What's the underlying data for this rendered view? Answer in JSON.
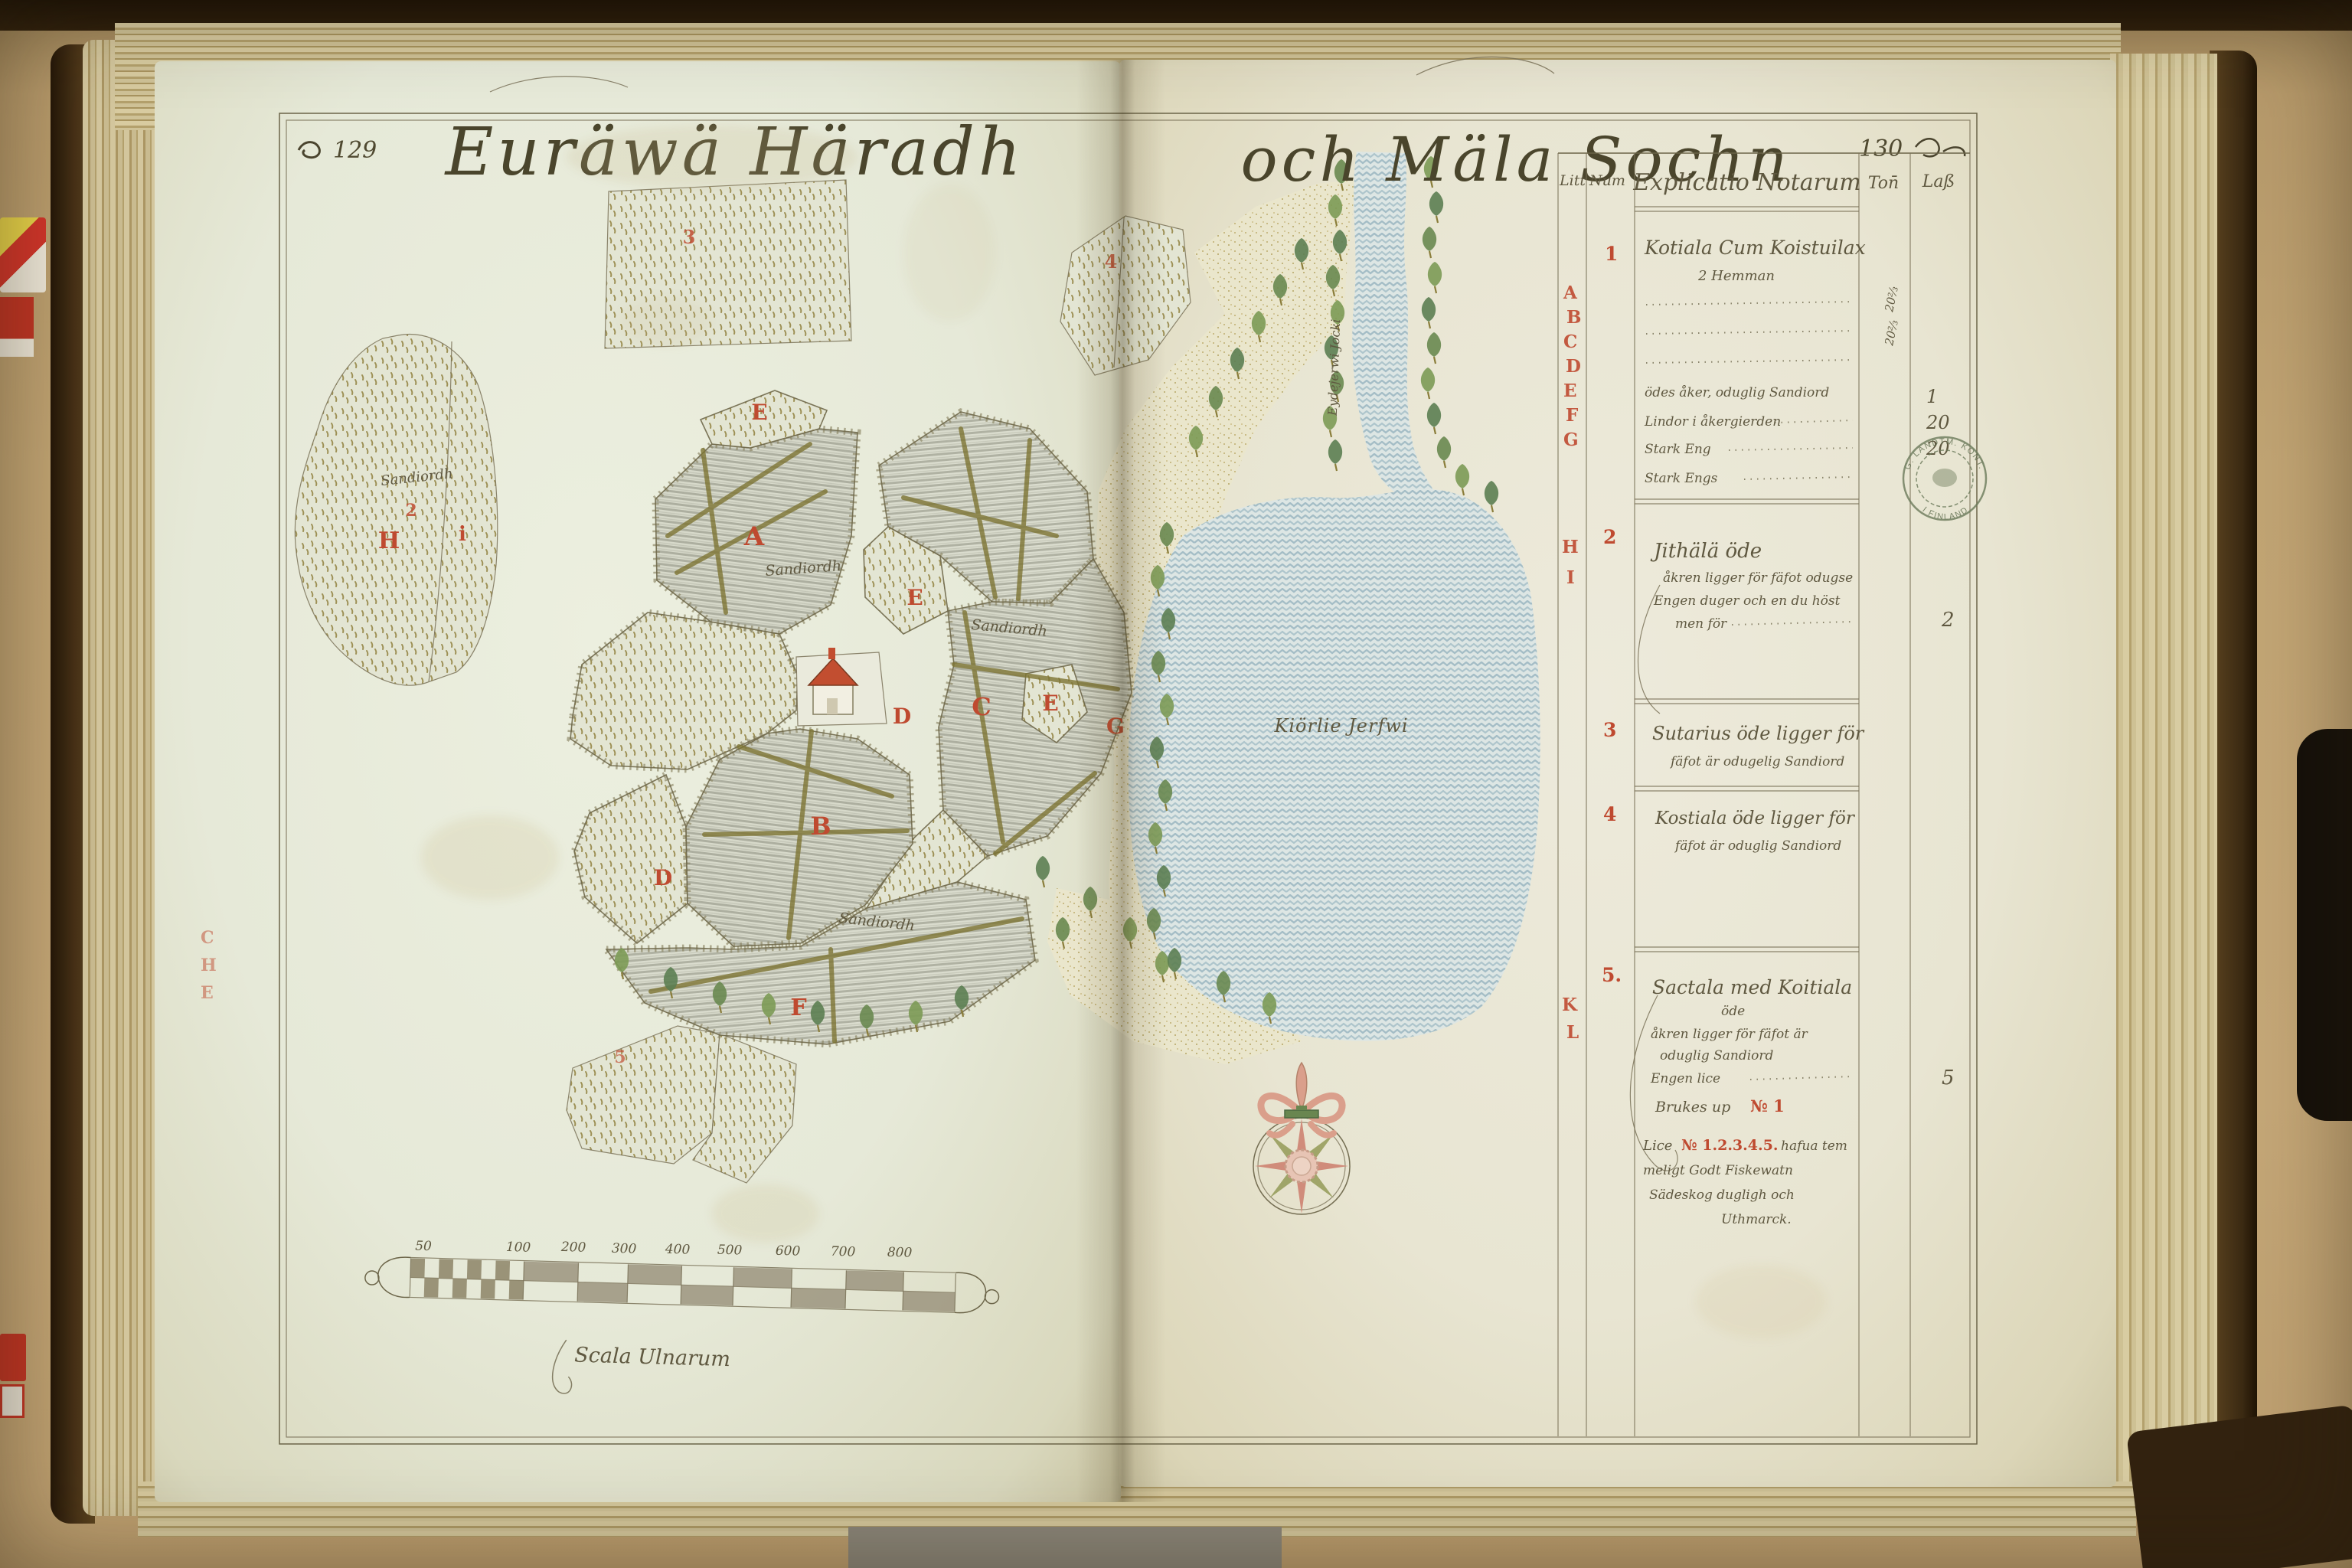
{
  "header": {
    "page_left": "129",
    "title_left": "Euräwä Häradh",
    "title_right": "och Mäla Sochn",
    "page_right": "130"
  },
  "map": {
    "lake_label": "Kiörlie Jerfwi",
    "river_label": "Eydejerwi Jocki",
    "soil_label": "Sandiordh",
    "numbers": {
      "blob": "2",
      "top_field": "3",
      "east_patch": "4",
      "south_patch": "5"
    },
    "letters": {
      "e_top": "E",
      "a": "A",
      "e_mid": "E",
      "d_mid": "D",
      "c": "C",
      "e_right": "E",
      "g": "G",
      "b": "B",
      "d_low": "D",
      "f": "F",
      "h": "H",
      "i": "i"
    },
    "edge_letters": [
      "C",
      "H",
      "E"
    ]
  },
  "scale_bar": {
    "label": "Scala Ulnarum",
    "ticks": [
      "50",
      "100",
      "200",
      "300",
      "400",
      "500",
      "600",
      "700",
      "800"
    ]
  },
  "table": {
    "headers": {
      "litt": "Litt",
      "num": "Num",
      "explicatio": "Explicatio Notarum",
      "col1": "Ton̄",
      "col2": "Laß"
    },
    "litt1": [
      "A",
      "B",
      "C",
      "D",
      "E",
      "F",
      "G"
    ],
    "litt2": [
      "H",
      "I"
    ],
    "litt3": [
      "K",
      "L"
    ],
    "entries": [
      {
        "num": "1",
        "name": "Kotiala Cum Koistuilax",
        "sub": "2 Hemman",
        "side_values": [
          "20⅔",
          "20⅔"
        ],
        "lines": [
          "ödes åker, oduglig Sandiord",
          "Lindor i åkergierden",
          "Stark Eng",
          "Stark Engs"
        ],
        "values": [
          "1",
          "20",
          "20"
        ]
      },
      {
        "num": "2",
        "name": "Jithälä öde",
        "lines": [
          "åkren ligger för fäfot odugse",
          "Engen duger och en du höst",
          "men för"
        ],
        "value": "2"
      },
      {
        "num": "3",
        "name": "Sutarius öde ligger för",
        "line2": "fäfot är odugelig Sandiord"
      },
      {
        "num": "4",
        "name": "Kostiala öde ligger för",
        "line2": "fäfot är oduglig Sandiord"
      },
      {
        "num": "5.",
        "name": "Sactala med Koitiala",
        "sub": "öde",
        "lines": [
          "åkren ligger för fäfot är",
          "oduglig Sandiord",
          "Engen lice"
        ],
        "value": "5",
        "brukes": "Brukes up",
        "brukes_no": "№ 1",
        "note_pre": "Lice",
        "note_no": "№ 1.2.3.4.5.",
        "note_post": "hafua tem",
        "note2": "meligt Godt Fiskewatn",
        "note3": "Sädeskog dugligh och",
        "note4": "Uthmarck."
      }
    ]
  },
  "stamp": {
    "arc_top": "G. LANDTM. KONT.",
    "arc_bottom": "I FINLAND"
  }
}
